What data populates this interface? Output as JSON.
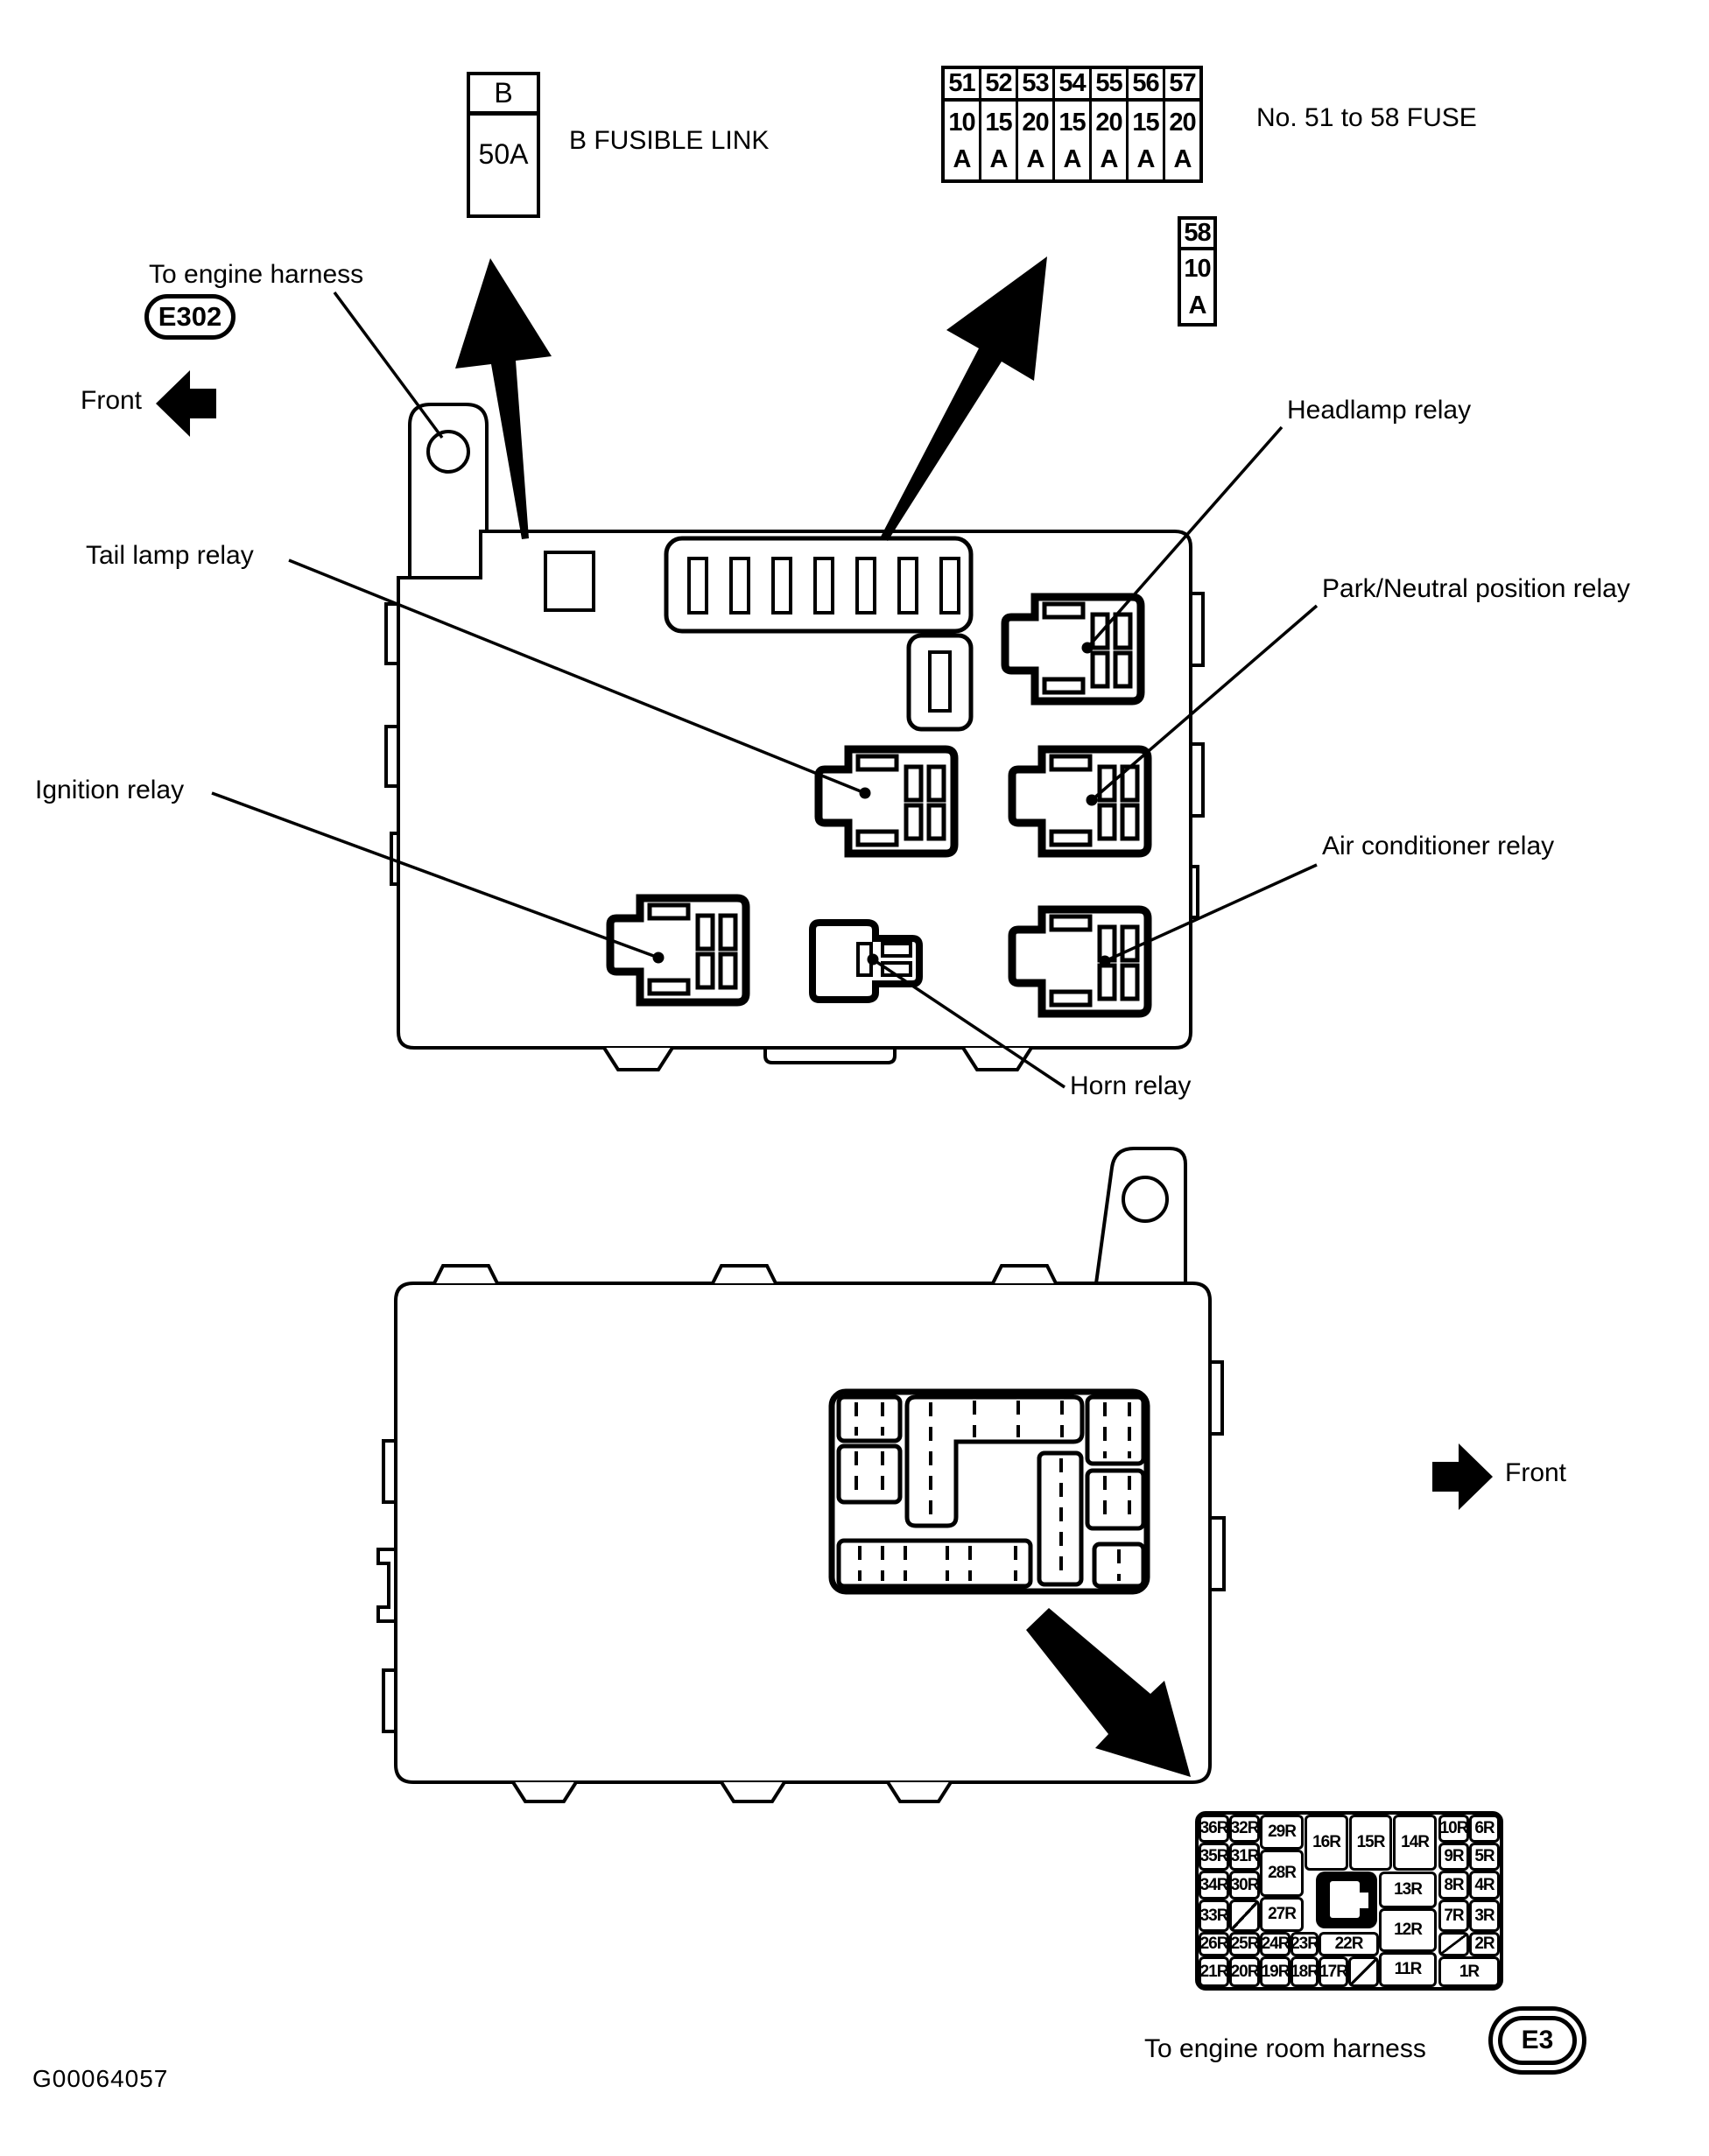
{
  "figure": {
    "code": "G00064057"
  },
  "colors": {
    "ink": "#000000",
    "paper": "#ffffff"
  },
  "fusible_link": {
    "name": "B",
    "rating": "50A",
    "caption": "B FUSIBLE LINK"
  },
  "fuse_strip": {
    "caption": "No. 51 to 58 FUSE",
    "unit": "A",
    "fuses": [
      {
        "no": "51",
        "amp": "10"
      },
      {
        "no": "52",
        "amp": "15"
      },
      {
        "no": "53",
        "amp": "20"
      },
      {
        "no": "54",
        "amp": "15"
      },
      {
        "no": "55",
        "amp": "20"
      },
      {
        "no": "56",
        "amp": "15"
      },
      {
        "no": "57",
        "amp": "20"
      }
    ],
    "fuse_58": {
      "no": "58",
      "amp": "10"
    }
  },
  "upper_box": {
    "harness_label": "To engine harness",
    "harness_connector": "E302",
    "front_label": "Front",
    "relay_labels": {
      "tail_lamp": "Tail lamp relay",
      "ignition": "Ignition relay",
      "headlamp": "Headlamp relay",
      "park_neutral": "Park/Neutral position relay",
      "air_conditioner": "Air conditioner relay",
      "horn": "Horn relay"
    }
  },
  "lower_box": {
    "front_label": "Front",
    "harness_label": "To engine room harness",
    "harness_connector": "E3",
    "relay_grid": {
      "labels": {
        "r36": "36R",
        "r35": "35R",
        "r34": "34R",
        "r33": "33R",
        "r32": "32R",
        "r31": "31R",
        "r30": "30R",
        "r29": "29R",
        "r28": "28R",
        "r27": "27R",
        "r26": "26R",
        "r25": "25R",
        "r24": "24R",
        "r23": "23R",
        "r22": "22R",
        "r21": "21R",
        "r20": "20R",
        "r19": "19R",
        "r18": "18R",
        "r17": "17R",
        "r16": "16R",
        "r15": "15R",
        "r14": "14R",
        "r13": "13R",
        "r12": "12R",
        "r11": "11R",
        "r10": "10R",
        "r9": "9R",
        "r8": "8R",
        "r7": "7R",
        "r6": "6R",
        "r5": "5R",
        "r4": "4R",
        "r3": "3R",
        "r2": "2R",
        "r1": "1R"
      }
    }
  }
}
